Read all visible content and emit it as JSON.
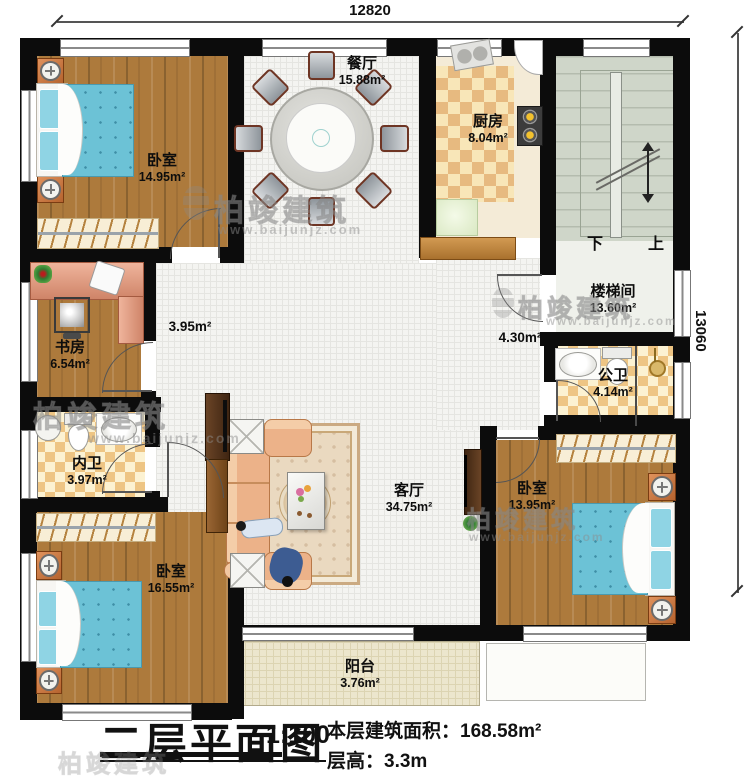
{
  "dimensions": {
    "top": "12820",
    "right": "13060"
  },
  "stairs": {
    "down": "下",
    "up": "上"
  },
  "watermark": {
    "brand": "柏竣建筑",
    "url": "www.baijunjz.com"
  },
  "rooms": {
    "bedroom_tl": {
      "name": "卧室",
      "area": "14.95m²"
    },
    "dining": {
      "name": "餐厅",
      "area": "15.88m²"
    },
    "kitchen": {
      "name": "厨房",
      "area": "8.04m²"
    },
    "stairwell": {
      "name": "楼梯间",
      "area": "13.60m²"
    },
    "study": {
      "name": "书房",
      "area": "6.54m²"
    },
    "hall_center": {
      "area": "3.95m²"
    },
    "hall_east": {
      "area": "4.30m²"
    },
    "bath_public": {
      "name": "公卫",
      "area": "4.14m²"
    },
    "bath_private": {
      "name": "内卫",
      "area": "3.97m²"
    },
    "living": {
      "name": "客厅",
      "area": "34.75m²"
    },
    "bedroom_bl": {
      "name": "卧室",
      "area": "16.55m²"
    },
    "bedroom_br": {
      "name": "卧室",
      "area": "13.95m²"
    },
    "balcony": {
      "name": "阳台",
      "area": "3.76m²"
    }
  },
  "title": {
    "main": "二层平面图",
    "scale": "1:100",
    "area_label": "本层建筑面积：",
    "area_value": "168.58m²",
    "height_label": "层高：",
    "height_value": "3.3m"
  }
}
